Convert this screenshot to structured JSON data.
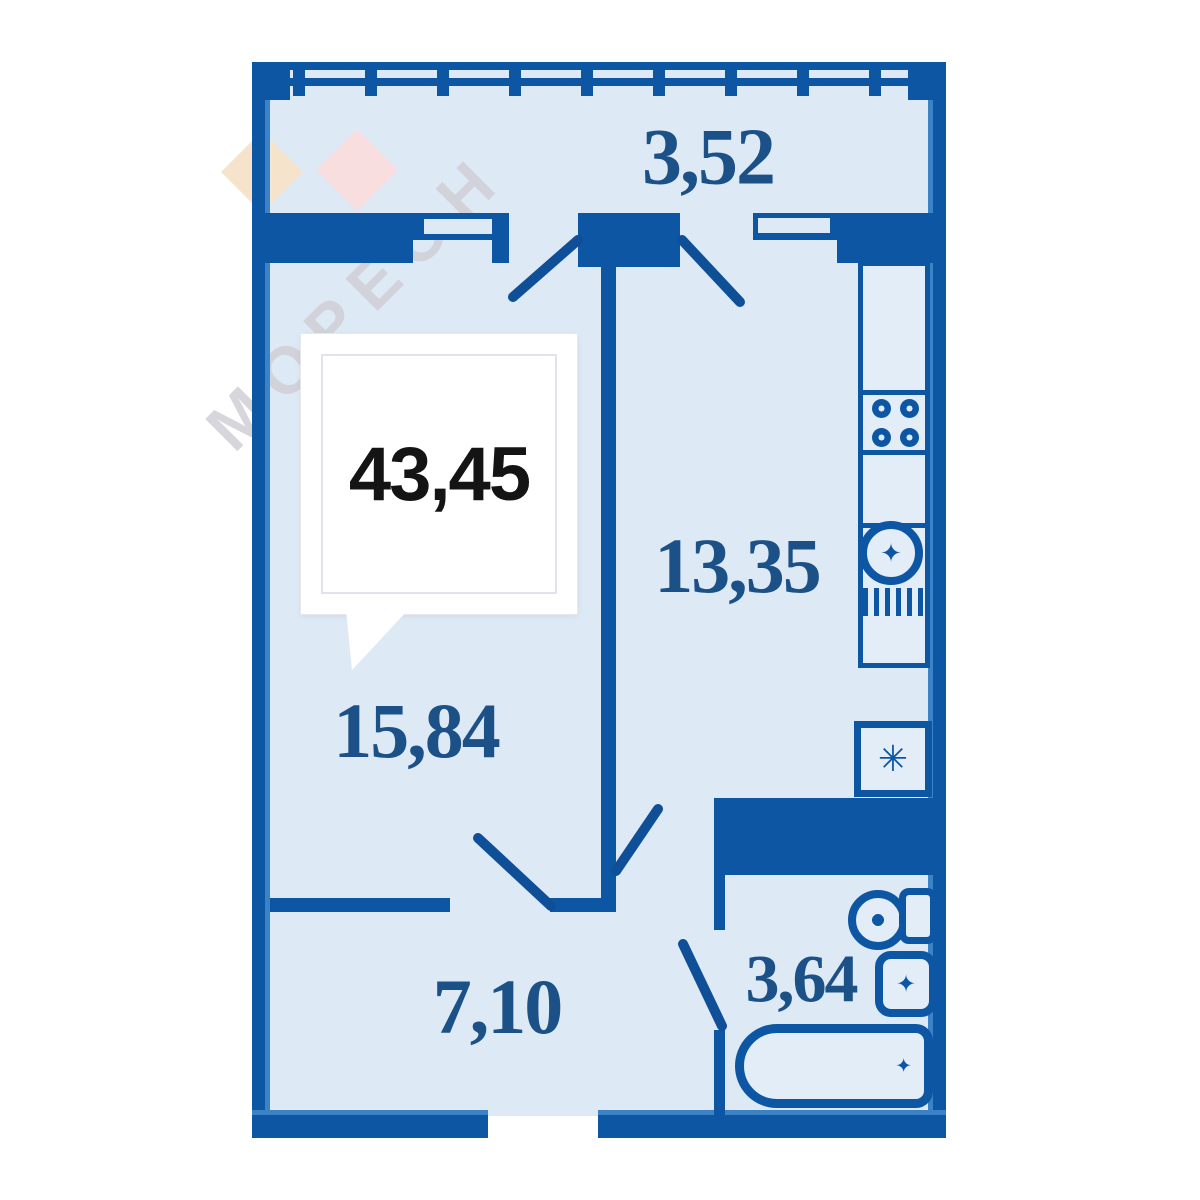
{
  "plan": {
    "callout": {
      "total_area": "43,45"
    },
    "rooms": [
      {
        "name": "balcony",
        "area": "3,52"
      },
      {
        "name": "kitchen",
        "area": "13,35"
      },
      {
        "name": "living-room",
        "area": "15,84"
      },
      {
        "name": "hallway",
        "area": "7,10"
      },
      {
        "name": "bathroom",
        "area": "3,64"
      }
    ],
    "watermark": {
      "text": "МОРЕОН"
    },
    "icons": {
      "fridge_snowflake": "✳",
      "sink_star": "✦",
      "basin_star": "✦",
      "tub_drain_star": "✦"
    },
    "colors": {
      "wall": "#0c56a4",
      "wall_highlight": "#3b82c6",
      "floor": "#dde9f5",
      "room_label": "#1b5186",
      "total_label": "#141414",
      "watermark_text": "#cfcfd6",
      "watermark_diamond_1": "#f6e3cb",
      "watermark_diamond_2": "#f8dede"
    }
  }
}
